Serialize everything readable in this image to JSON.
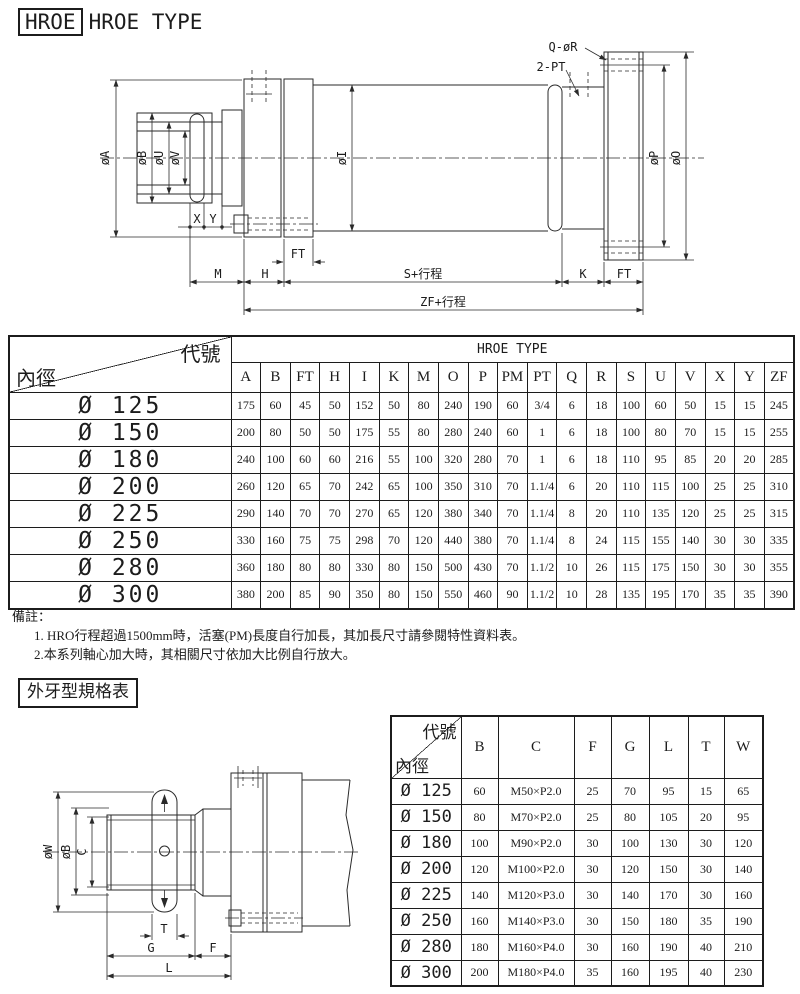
{
  "page": {
    "ink": "#1c1c1c",
    "paper": "#ffffff"
  },
  "header": {
    "title_box": "HROE",
    "title_text": "HROE TYPE"
  },
  "drawing1": {
    "labels": {
      "q_r": "Q-øR",
      "two_pt": "2-PT",
      "dia_a": "øA",
      "dia_b": "øB",
      "dia_u": "øU",
      "dia_v": "øV",
      "dia_i": "øI",
      "dia_p": "øP",
      "dia_o": "øO",
      "x": "X",
      "y": "Y",
      "ft_left": "FT",
      "m": "M",
      "h": "H",
      "s_stroke": "S+行程",
      "k": "K",
      "ft_right": "FT",
      "zf_stroke": "ZF+行程"
    }
  },
  "table1": {
    "corner_top": "代號",
    "corner_bottom": "內徑",
    "span_header": "HROE TYPE",
    "columns": [
      "A",
      "B",
      "FT",
      "H",
      "I",
      "K",
      "M",
      "O",
      "P",
      "PM",
      "PT",
      "Q",
      "R",
      "S",
      "U",
      "V",
      "X",
      "Y",
      "ZF"
    ],
    "rows": [
      {
        "label": "Ø 125",
        "values": [
          "175",
          "60",
          "45",
          "50",
          "152",
          "50",
          "80",
          "240",
          "190",
          "60",
          "3/4",
          "6",
          "18",
          "100",
          "60",
          "50",
          "15",
          "15",
          "245"
        ]
      },
      {
        "label": "Ø 150",
        "values": [
          "200",
          "80",
          "50",
          "50",
          "175",
          "55",
          "80",
          "280",
          "240",
          "60",
          "1",
          "6",
          "18",
          "100",
          "80",
          "70",
          "15",
          "15",
          "255"
        ]
      },
      {
        "label": "Ø 180",
        "values": [
          "240",
          "100",
          "60",
          "60",
          "216",
          "55",
          "100",
          "320",
          "280",
          "70",
          "1",
          "6",
          "18",
          "110",
          "95",
          "85",
          "20",
          "20",
          "285"
        ]
      },
      {
        "label": "Ø 200",
        "values": [
          "260",
          "120",
          "65",
          "70",
          "242",
          "65",
          "100",
          "350",
          "310",
          "70",
          "1.1/4",
          "6",
          "20",
          "110",
          "115",
          "100",
          "25",
          "25",
          "310"
        ]
      },
      {
        "label": "Ø 225",
        "values": [
          "290",
          "140",
          "70",
          "70",
          "270",
          "65",
          "120",
          "380",
          "340",
          "70",
          "1.1/4",
          "8",
          "20",
          "110",
          "135",
          "120",
          "25",
          "25",
          "315"
        ]
      },
      {
        "label": "Ø 250",
        "values": [
          "330",
          "160",
          "75",
          "75",
          "298",
          "70",
          "120",
          "440",
          "380",
          "70",
          "1.1/4",
          "8",
          "24",
          "115",
          "155",
          "140",
          "30",
          "30",
          "335"
        ]
      },
      {
        "label": "Ø 280",
        "values": [
          "360",
          "180",
          "80",
          "80",
          "330",
          "80",
          "150",
          "500",
          "430",
          "70",
          "1.1/2",
          "10",
          "26",
          "115",
          "175",
          "150",
          "30",
          "30",
          "355"
        ]
      },
      {
        "label": "Ø 300",
        "values": [
          "380",
          "200",
          "85",
          "90",
          "350",
          "80",
          "150",
          "550",
          "460",
          "90",
          "1.1/2",
          "10",
          "28",
          "135",
          "195",
          "170",
          "35",
          "35",
          "390"
        ]
      }
    ]
  },
  "notes": {
    "title": "備註：",
    "items": [
      "1. HRO行程超過1500mm時，活塞(PM)長度自行加長，其加長尺寸請參閱特性資料表。",
      "2.本系列軸心加大時，其相關尺寸依加大比例自行放大。"
    ]
  },
  "section2": {
    "title": "外牙型規格表"
  },
  "drawing2": {
    "labels": {
      "dia_w": "øW",
      "dia_b": "øB",
      "c": "C",
      "t": "T",
      "g": "G",
      "f": "F",
      "l": "L"
    }
  },
  "table2": {
    "corner_top": "代號",
    "corner_bottom": "內徑",
    "columns": [
      "B",
      "C",
      "F",
      "G",
      "L",
      "T",
      "W"
    ],
    "rows": [
      {
        "label": "Ø 125",
        "values": [
          "60",
          "M50×P2.0",
          "25",
          "70",
          "95",
          "15",
          "65"
        ]
      },
      {
        "label": "Ø 150",
        "values": [
          "80",
          "M70×P2.0",
          "25",
          "80",
          "105",
          "20",
          "95"
        ]
      },
      {
        "label": "Ø 180",
        "values": [
          "100",
          "M90×P2.0",
          "30",
          "100",
          "130",
          "30",
          "120"
        ]
      },
      {
        "label": "Ø 200",
        "values": [
          "120",
          "M100×P2.0",
          "30",
          "120",
          "150",
          "30",
          "140"
        ]
      },
      {
        "label": "Ø 225",
        "values": [
          "140",
          "M120×P3.0",
          "30",
          "140",
          "170",
          "30",
          "160"
        ]
      },
      {
        "label": "Ø 250",
        "values": [
          "160",
          "M140×P3.0",
          "30",
          "150",
          "180",
          "35",
          "190"
        ]
      },
      {
        "label": "Ø 280",
        "values": [
          "180",
          "M160×P4.0",
          "30",
          "160",
          "190",
          "40",
          "210"
        ]
      },
      {
        "label": "Ø 300",
        "values": [
          "200",
          "M180×P4.0",
          "35",
          "160",
          "195",
          "40",
          "230"
        ]
      }
    ]
  }
}
